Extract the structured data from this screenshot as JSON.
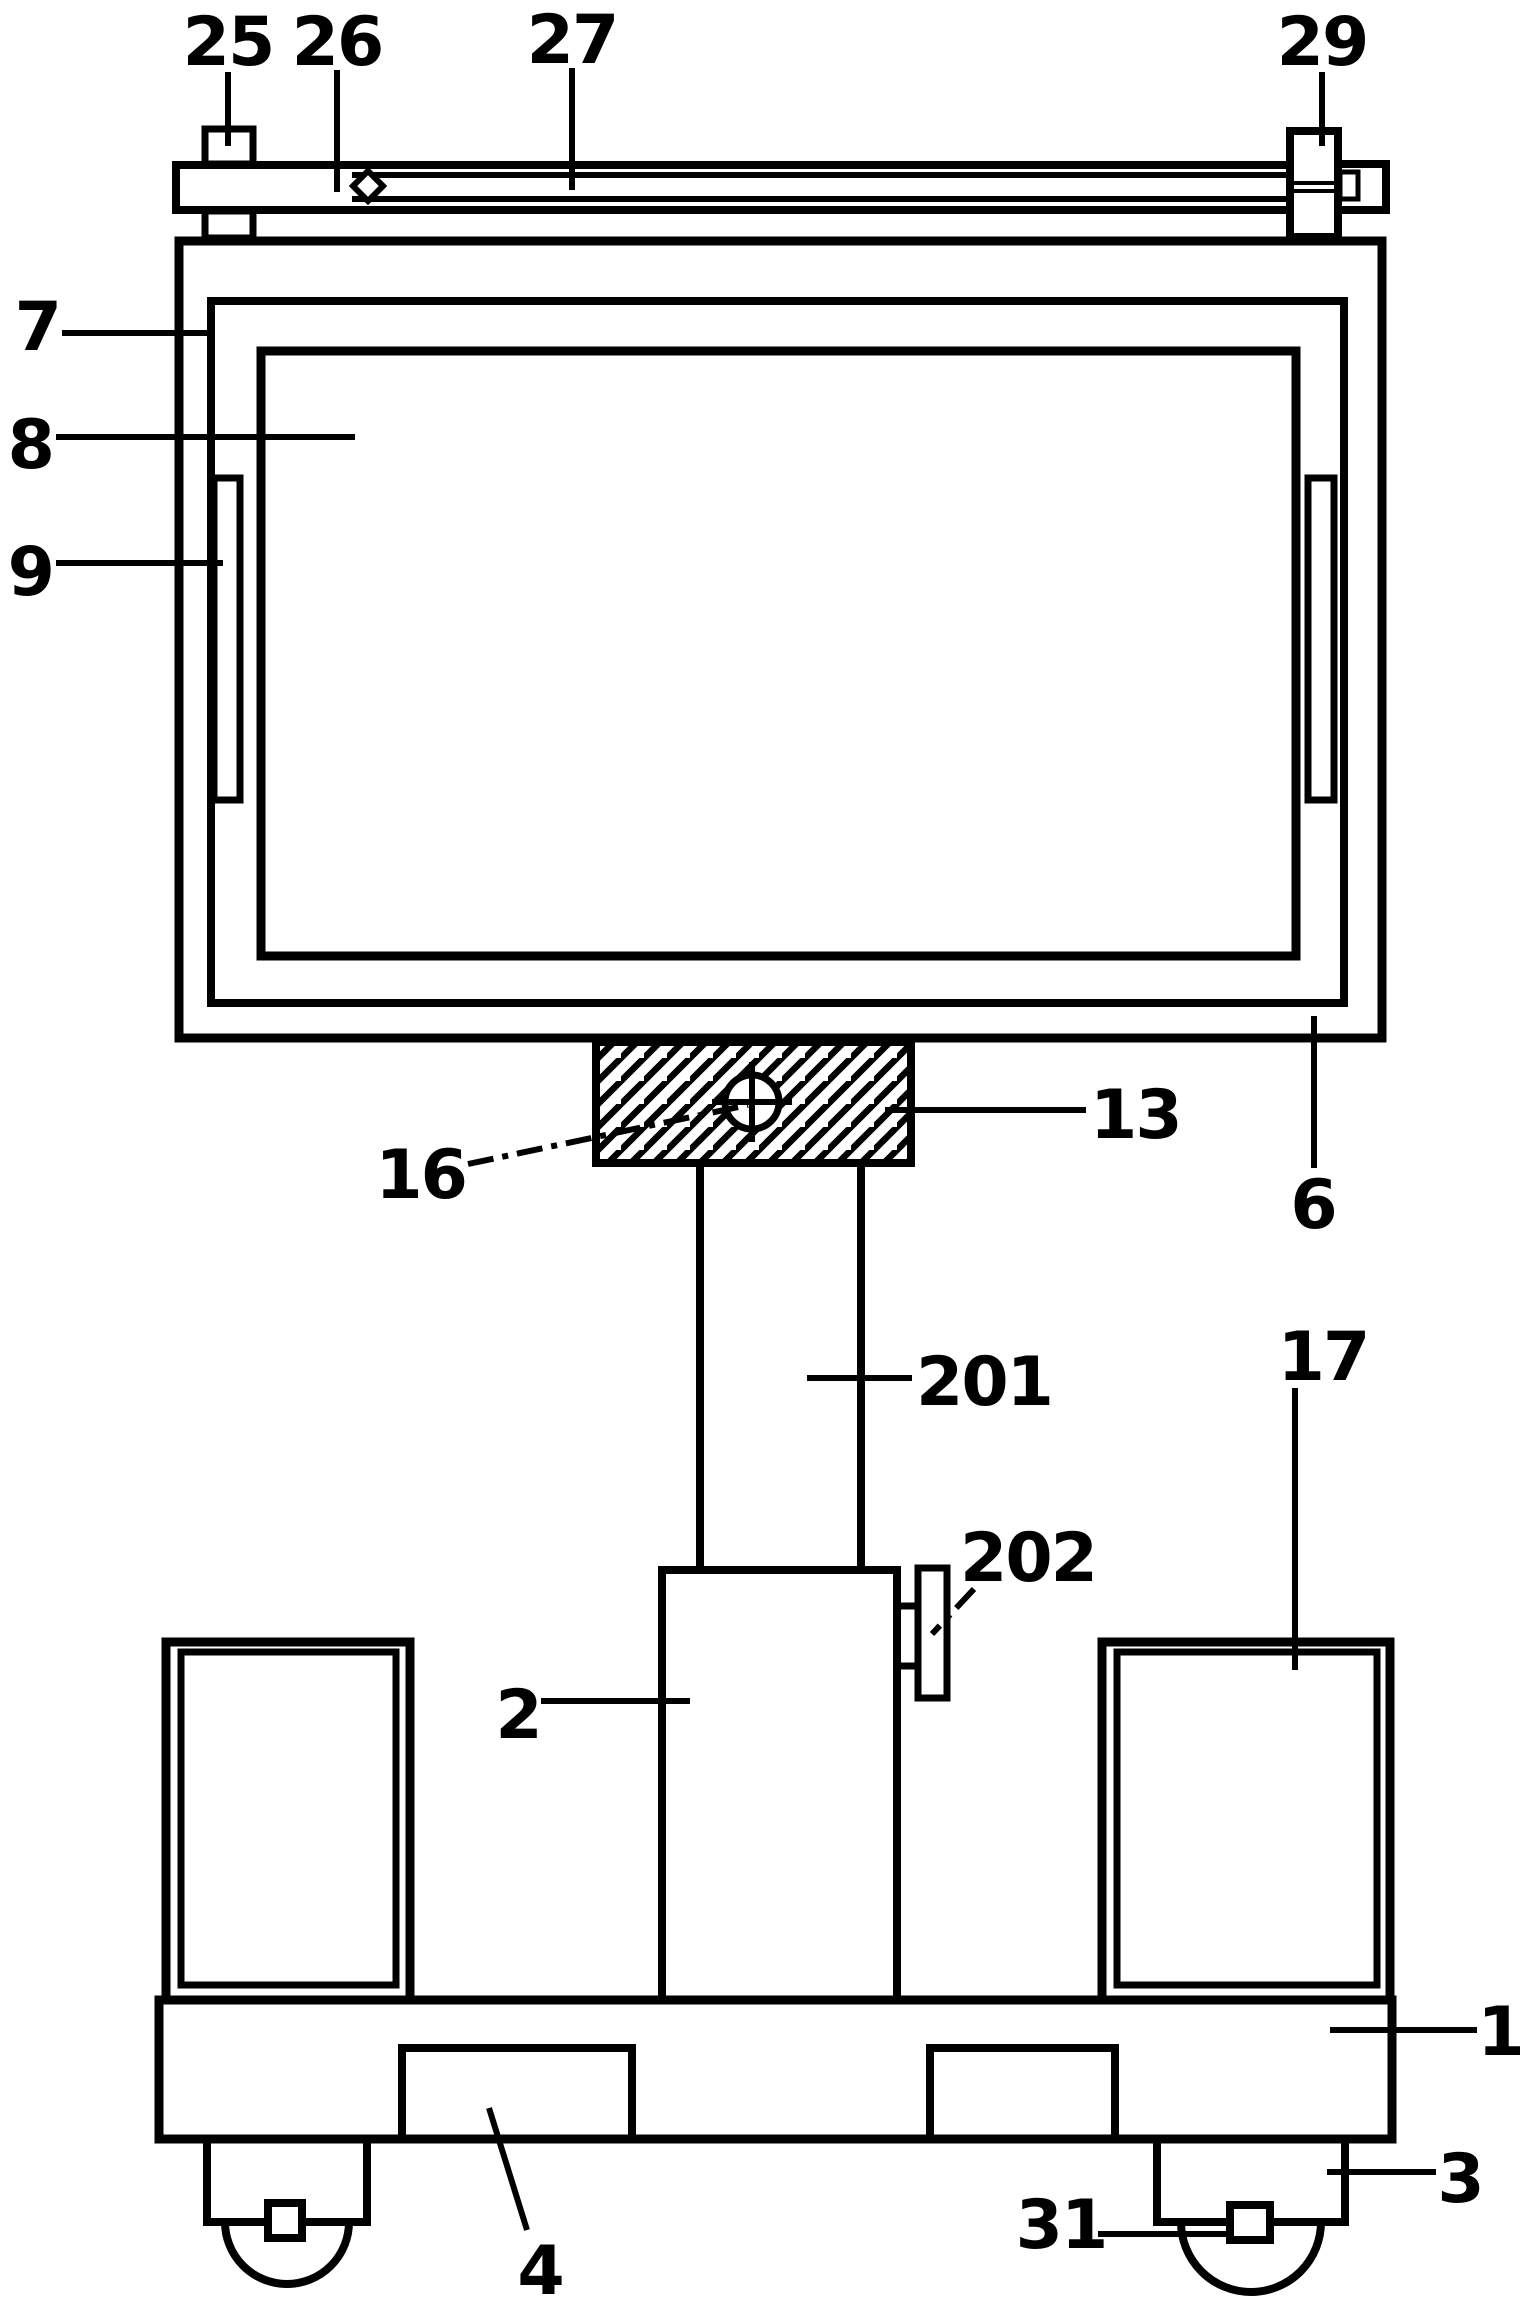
{
  "figure": {
    "type": "patent-line-drawing",
    "background_color": "#ffffff",
    "ink_color": "#000000",
    "labels": {
      "1": "1",
      "2": "2",
      "3": "3",
      "4": "4",
      "6": "6",
      "7": "7",
      "8": "8",
      "9": "9",
      "13": "13",
      "16": "16",
      "17": "17",
      "25": "25",
      "26": "26",
      "27": "27",
      "29": "29",
      "31": "31",
      "201": "201",
      "202": "202"
    }
  }
}
